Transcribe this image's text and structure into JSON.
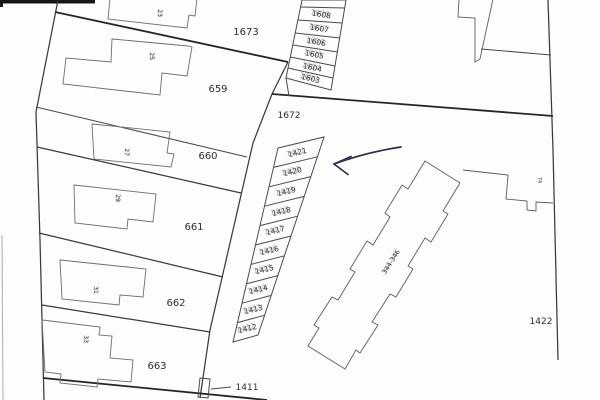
{
  "map_labels": {
    "top_strip": [
      "1608",
      "1607",
      "1606",
      "1605",
      "1604",
      "1603"
    ],
    "block_parcels": [
      "1673",
      "659",
      "660",
      "661",
      "662",
      "663"
    ],
    "road_parcel": "1672",
    "mid_strip": [
      "1421",
      "1420",
      "1419",
      "1418",
      "1417",
      "1416",
      "1415",
      "1414",
      "1413",
      "1412"
    ],
    "narrow_parcel": "1411",
    "east_parcel": "1422",
    "apartment_building": "344-346",
    "small_building": "74",
    "house_numbers": [
      "23",
      "25",
      "27",
      "29",
      "31",
      "33"
    ]
  },
  "colors": {
    "ink": "#2e2e2e",
    "boundary": "#3a3a3a",
    "annotation_arrow": "#2e2e48",
    "paper": "#fdfdfc"
  }
}
